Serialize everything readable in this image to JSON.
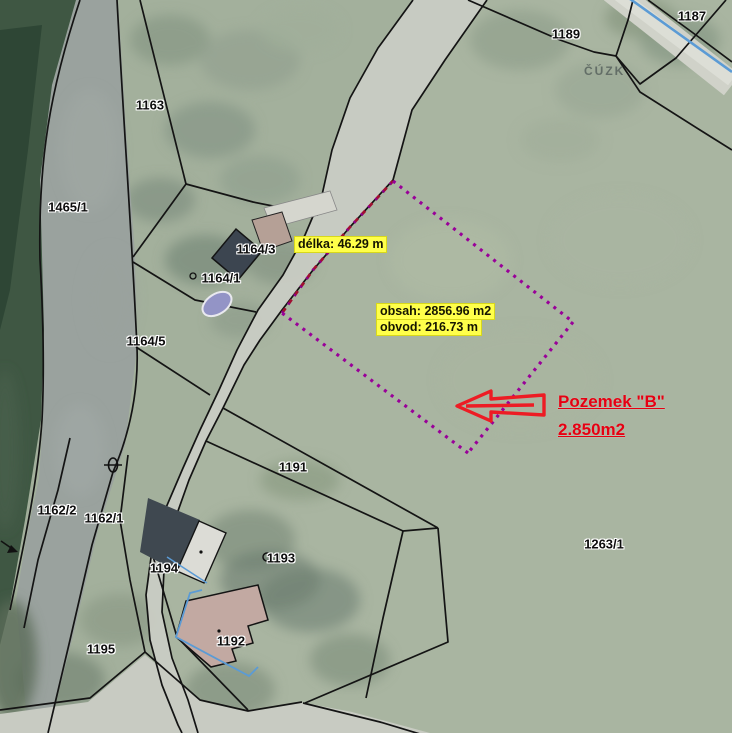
{
  "map": {
    "watermark": "ČÚZK",
    "parcels": [
      {
        "id": "1187",
        "x": 692,
        "y": 16
      },
      {
        "id": "1189",
        "x": 566,
        "y": 34
      },
      {
        "id": "1163",
        "x": 150,
        "y": 105
      },
      {
        "id": "1465/1",
        "x": 68,
        "y": 207
      },
      {
        "id": "1164/3",
        "x": 256,
        "y": 249
      },
      {
        "id": "1164/1",
        "x": 221,
        "y": 278
      },
      {
        "id": "1164/5",
        "x": 146,
        "y": 341
      },
      {
        "id": "1191",
        "x": 293,
        "y": 467
      },
      {
        "id": "1162/2",
        "x": 57,
        "y": 510
      },
      {
        "id": "1162/1",
        "x": 104,
        "y": 518
      },
      {
        "id": "1194",
        "x": 164,
        "y": 568
      },
      {
        "id": "1193",
        "x": 281,
        "y": 558
      },
      {
        "id": "1192",
        "x": 231,
        "y": 641
      },
      {
        "id": "1195",
        "x": 101,
        "y": 649
      },
      {
        "id": "1263/1",
        "x": 604,
        "y": 544
      }
    ],
    "measurements": [
      {
        "text": "délka: 46.29 m",
        "x": 294,
        "y": 236
      },
      {
        "text": "obsah: 2856.96 m2",
        "x": 376,
        "y": 303
      },
      {
        "text": "obvod: 216.73 m",
        "x": 376,
        "y": 319
      }
    ],
    "annotation": {
      "line1": "Pozemek \"B\"",
      "line2": "2.850m2"
    },
    "highlighted_parcel": {
      "name": "Pozemek B",
      "area_m2": "2856.96",
      "perimeter_m": "216.73",
      "edge_length_m": "46.29"
    },
    "icons": {
      "well_symbol": "circle-outline",
      "culvert_symbol": "ellipse-with-crossbar",
      "flow_arrow": "arrow-right",
      "pointer_arrow": "left-block-arrow"
    },
    "colors": {
      "highlight_purple": "#990099",
      "edge_red_dash": "#a01030",
      "measure_bg": "#ffff4a",
      "annotation_red": "#e60012",
      "boundary_black": "#141414",
      "overlay_blue": "#5b9bd5",
      "field_green": "#a3b09c",
      "forest_green": "#3f5743",
      "river_gray": "#9aa29e",
      "road_gray": "#c9ccc4"
    }
  }
}
